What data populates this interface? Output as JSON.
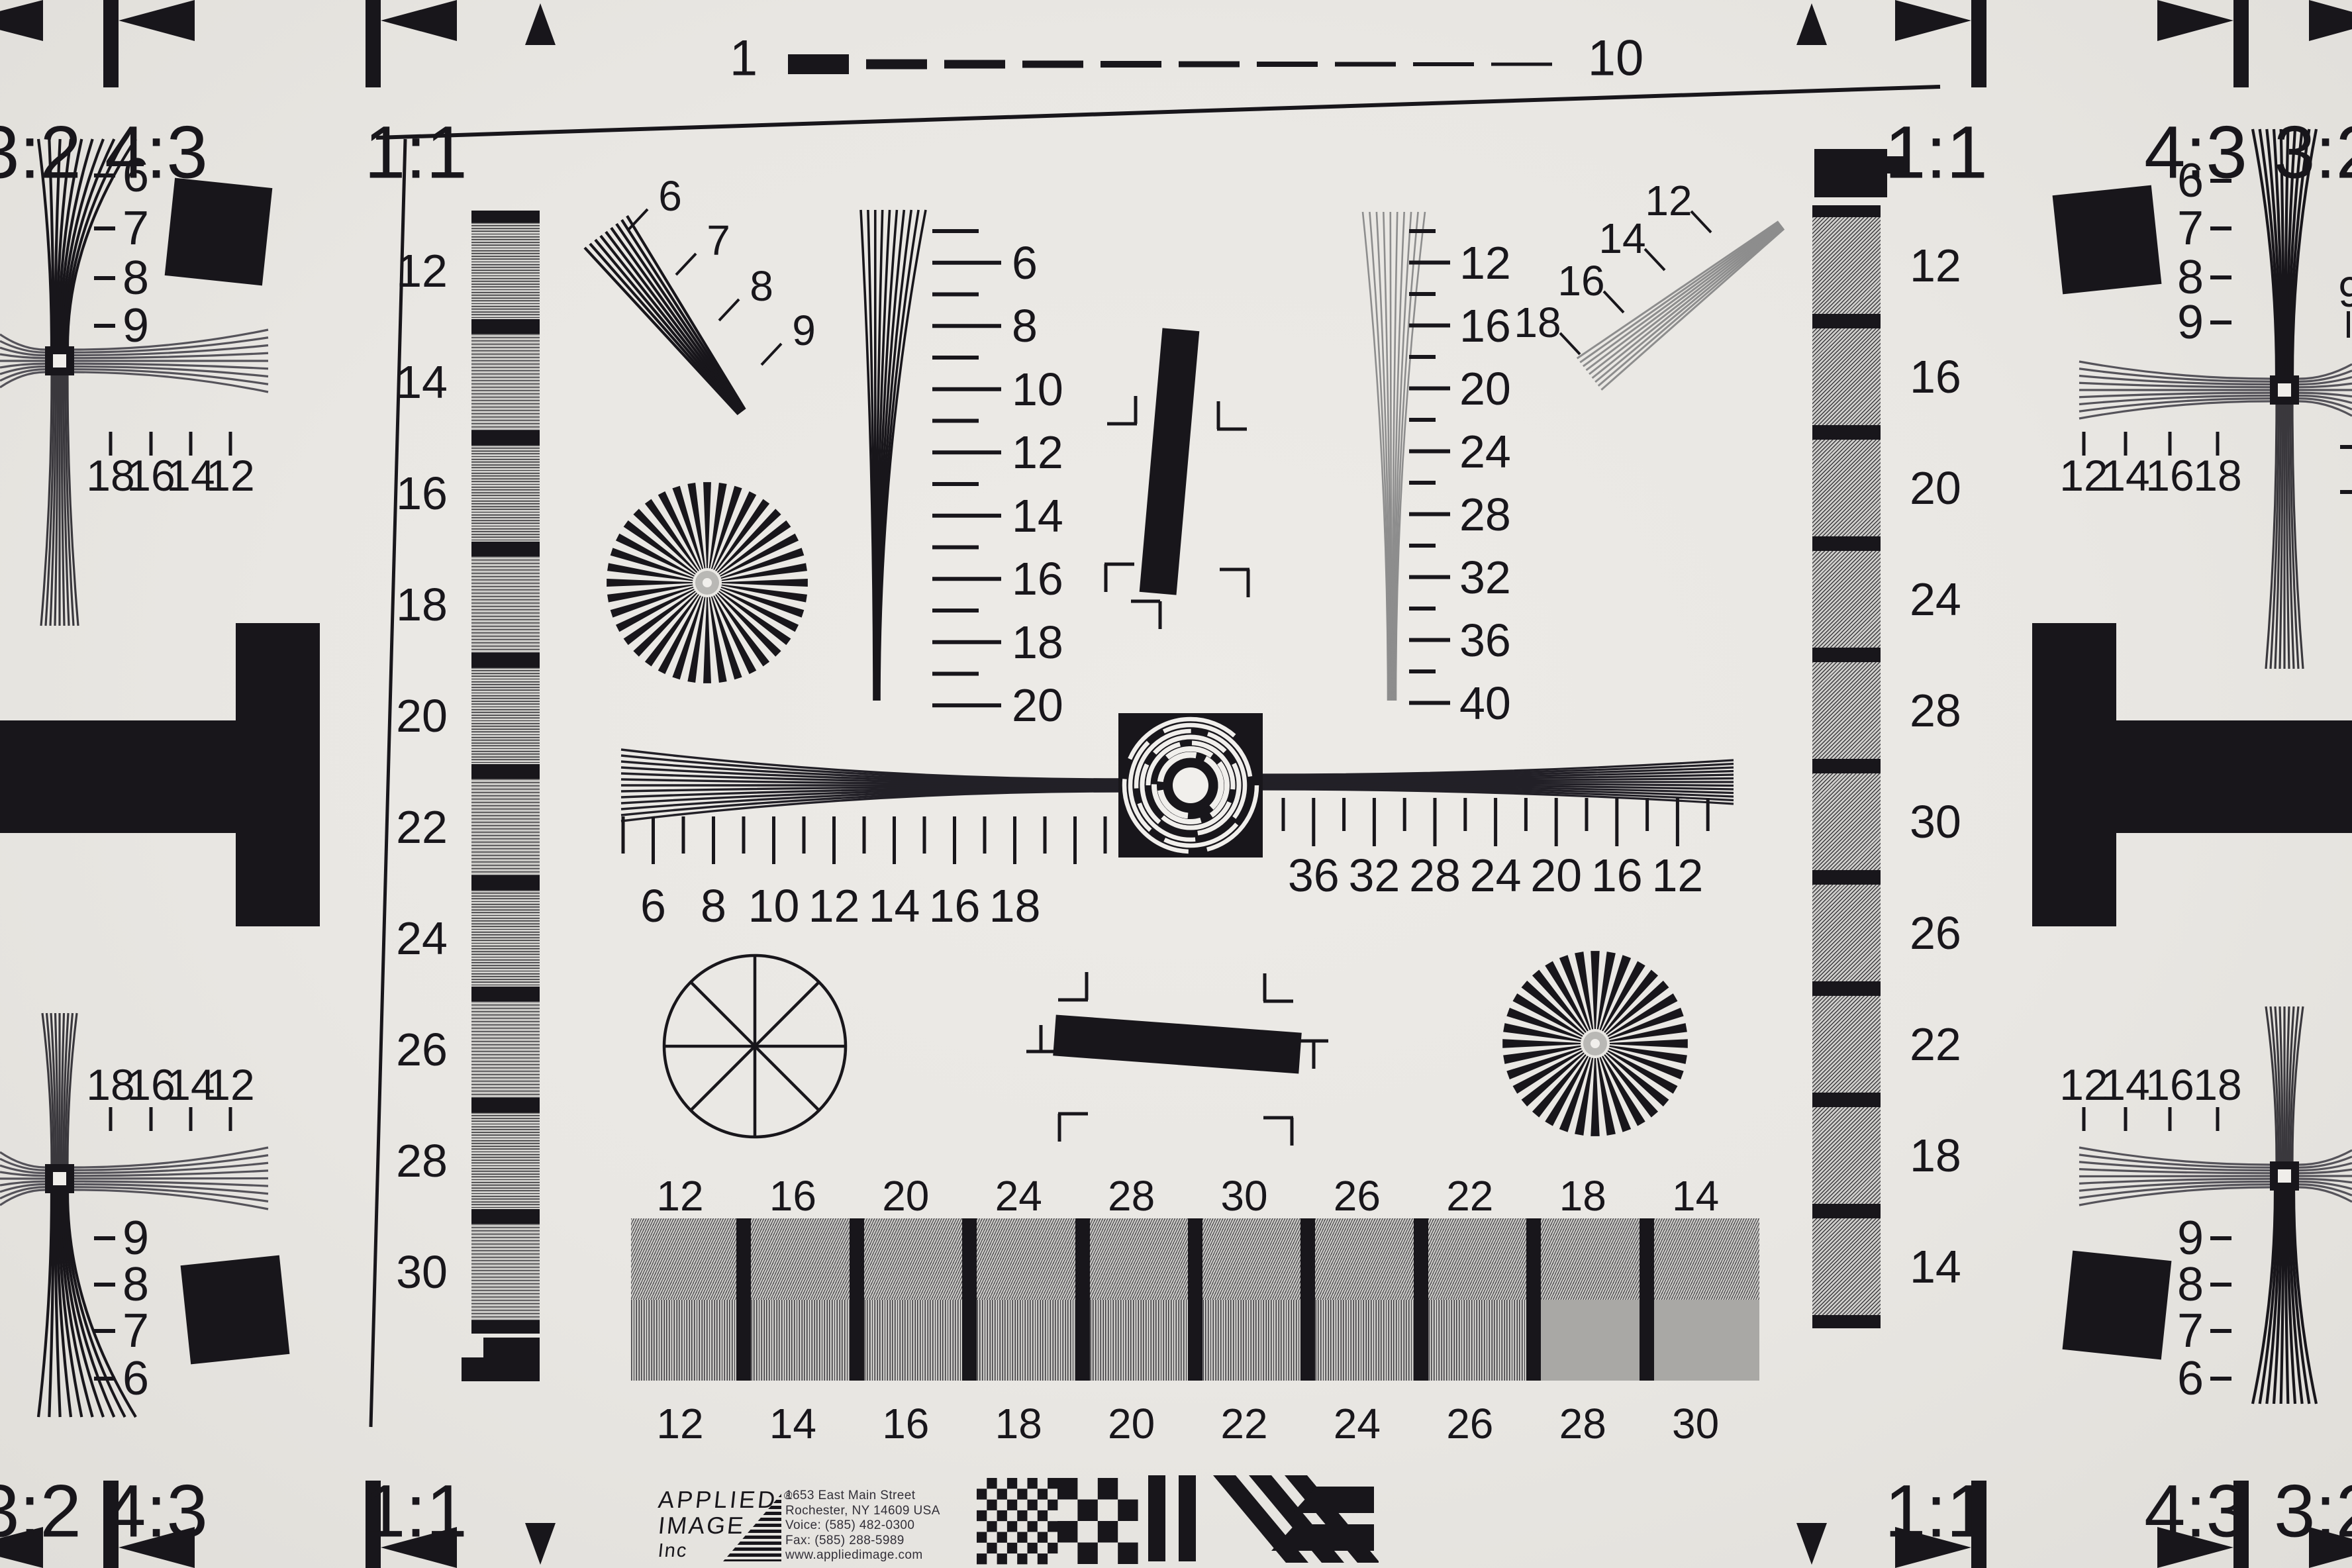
{
  "chart_title": "ISO 12233 style resolution test chart",
  "colors": {
    "paper": "#e9e7e3",
    "ink": "#18161b",
    "gray_line": "#8d8d8d",
    "mid_gray": "#a9a8a5"
  },
  "top_ruler": {
    "left_label": "1",
    "right_label": "10",
    "dash_count": 10
  },
  "aspect_labels": {
    "ratio_32": "3:2",
    "ratio_43": "4:3",
    "ratio_11": "1:1"
  },
  "corner_wedges": {
    "top_left_labels": [
      "6",
      "7",
      "8",
      "9"
    ],
    "top_right_labels": [
      "6",
      "7",
      "8",
      "9"
    ],
    "bottom_left_labels": [
      "9",
      "8",
      "7",
      "6"
    ],
    "bottom_right_labels": [
      "9",
      "8",
      "7",
      "6"
    ],
    "top_left_ticks": [
      "18",
      "16",
      "14",
      "12"
    ],
    "bottom_left_ticks": [
      "18",
      "16",
      "14",
      "12"
    ],
    "top_right_ticks": [
      "12",
      "14",
      "16",
      "18"
    ],
    "bottom_right_ticks": [
      "12",
      "14",
      "16",
      "18"
    ],
    "right_edge_fragment": "9"
  },
  "diagonal_wedges": {
    "upper_left": [
      "6",
      "7",
      "8",
      "9"
    ],
    "upper_right": [
      "12",
      "14",
      "16",
      "18"
    ]
  },
  "vertical_wedge_scales": {
    "left": [
      "6",
      "8",
      "10",
      "12",
      "14",
      "16",
      "18",
      "20"
    ],
    "right": [
      "12",
      "16",
      "20",
      "24",
      "28",
      "32",
      "36",
      "40"
    ]
  },
  "horizontal_sweep_scales": {
    "left": [
      "6",
      "8",
      "10",
      "12",
      "14",
      "16",
      "18"
    ],
    "right": [
      "36",
      "32",
      "28",
      "24",
      "20",
      "16",
      "12"
    ]
  },
  "gray_step_bars": {
    "left": [
      "12",
      "14",
      "16",
      "18",
      "20",
      "22",
      "24",
      "26",
      "28",
      "30"
    ],
    "right": [
      "12",
      "16",
      "20",
      "24",
      "28",
      "30",
      "26",
      "22",
      "18",
      "14"
    ]
  },
  "bottom_resolution_strip": {
    "top_row": [
      "12",
      "16",
      "20",
      "24",
      "28",
      "30",
      "26",
      "22",
      "18",
      "14"
    ],
    "bottom_row": [
      "12",
      "14",
      "16",
      "18",
      "20",
      "22",
      "24",
      "26",
      "28",
      "30"
    ]
  },
  "logo": {
    "company_line1": "APPLIED",
    "registered_mark": "®",
    "company_line2": "IMAGE",
    "company_line3": "Inc",
    "address": [
      "1653 East Main Street",
      "Rochester, NY  14609  USA",
      "Voice:   (585) 482-0300",
      "Fax:      (585) 288-5989",
      "www.appliedimage.com"
    ]
  }
}
